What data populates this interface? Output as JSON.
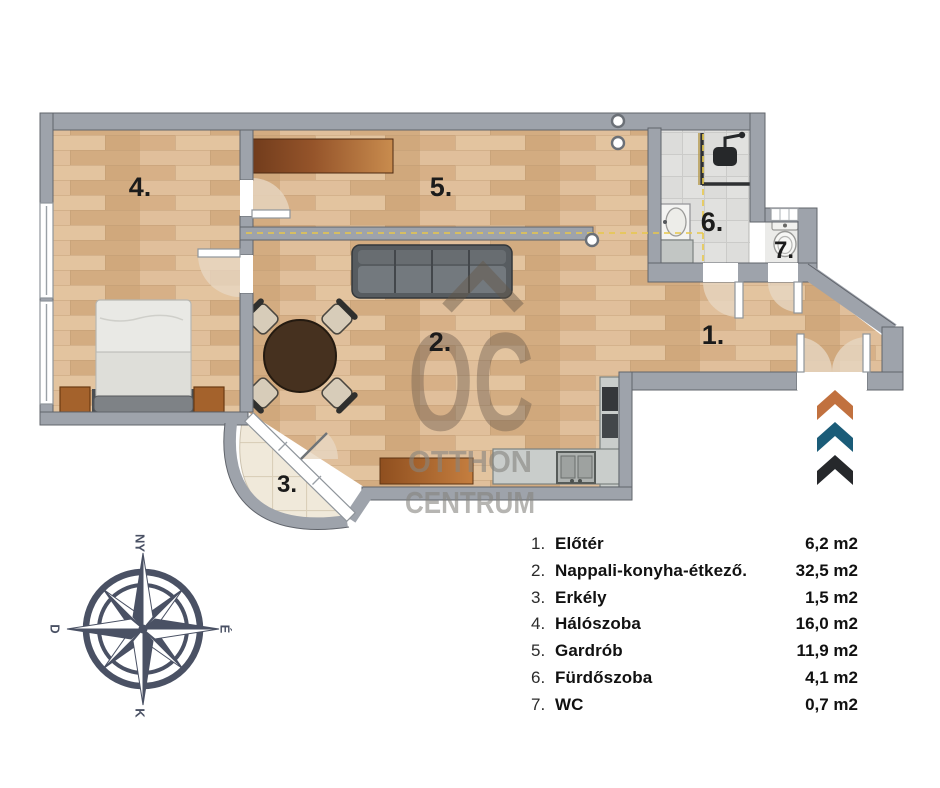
{
  "plan": {
    "room_labels": [
      {
        "label": "1."
      },
      {
        "label": "2."
      },
      {
        "label": "3."
      },
      {
        "label": "4."
      },
      {
        "label": "5."
      },
      {
        "label": "6."
      },
      {
        "label": "7."
      }
    ]
  },
  "legend": {
    "items": [
      {
        "num": "1.",
        "name": "Előtér",
        "area": "6,2 m2"
      },
      {
        "num": "2.",
        "name": "Nappali-konyha-étkező.",
        "area": "32,5 m2"
      },
      {
        "num": "3.",
        "name": "Erkély",
        "area": "1,5 m2"
      },
      {
        "num": "4.",
        "name": "Hálószoba",
        "area": "16,0 m2"
      },
      {
        "num": "5.",
        "name": "Gardrób",
        "area": "11,9 m2"
      },
      {
        "num": "6.",
        "name": "Fürdőszoba",
        "area": "4,1 m2"
      },
      {
        "num": "7.",
        "name": "WC",
        "area": "0,7 m2"
      }
    ]
  },
  "compass": {
    "top": "NY",
    "right": "É",
    "bottom": "K",
    "left": "D"
  },
  "watermark": {
    "logo": "OC",
    "line1": "OTTHON",
    "line2": "CENTRUM"
  },
  "colors": {
    "chevron_orange": "#C1713F",
    "chevron_teal": "#1B5C78",
    "chevron_black": "#26282B",
    "wall": "#9EA3AB",
    "marker_yellow": "#E8C84A",
    "compass": "#4A5164"
  }
}
